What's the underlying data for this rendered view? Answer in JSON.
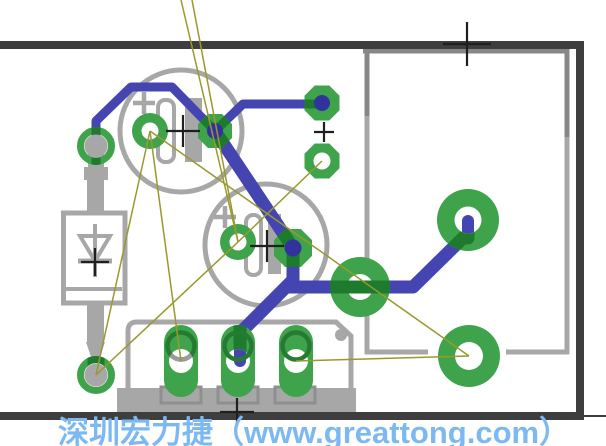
{
  "watermark": {
    "text": "深圳宏力捷（www.greattong.com）",
    "color": "#7cb9f3"
  },
  "colors": {
    "background": "#ffffff",
    "board_outline": "#3e3e3e",
    "silkscreen": "#a7a7a7",
    "silkscreen_dark": "#878787",
    "silkscreen_pin": "#8f8f8f",
    "pad_green": "#3ea34a",
    "pad_dark_green": "#1e7b2e",
    "terminal_ring_green": "#267b33",
    "terminal_ring_gray": "#9b9b9b",
    "trace_blue": "#4545b2",
    "hole_blue": "#32329e",
    "airwire_olive": "#99992e",
    "cross_black": "#1f1f1f",
    "white": "#ffffff"
  },
  "board_outline": {
    "segments": [
      {
        "name": "board-edge-top",
        "x1": 0,
        "y1": 45,
        "x2": 584,
        "y2": 45,
        "w": 8
      },
      {
        "name": "board-edge-right",
        "x1": 580,
        "y1": 45,
        "x2": 580,
        "y2": 416,
        "w": 8
      },
      {
        "name": "board-edge-bottom",
        "x1": 0,
        "y1": 416,
        "x2": 584,
        "y2": 416,
        "w": 8
      },
      {
        "name": "board-edge-stub",
        "x1": 584,
        "y1": 416,
        "x2": 606,
        "y2": 416,
        "w": 2
      }
    ]
  },
  "silkscreen": {
    "capacitors": [
      {
        "name": "capacitor-1",
        "circle": {
          "cx": 181,
          "cy": 131,
          "r": 61
        },
        "plus": {
          "x": 144,
          "y": 103
        },
        "bar_outline": {
          "x": 158,
          "y": 100,
          "w": 16,
          "h": 62
        },
        "bar_solid": {
          "x": 185,
          "y": 98,
          "w": 17,
          "h": 64
        }
      },
      {
        "name": "capacitor-2",
        "circle": {
          "cx": 266,
          "cy": 245,
          "r": 61
        },
        "plus": {
          "x": 225,
          "y": 217
        },
        "bar_outline": {
          "x": 246,
          "y": 215,
          "w": 15,
          "h": 60
        },
        "bar_solid": {
          "x": 268,
          "y": 214,
          "w": 13,
          "h": 60
        }
      }
    ],
    "diode": {
      "name": "diode",
      "body": {
        "x": 63.5,
        "y": 213,
        "w": 61.5,
        "h": 90
      },
      "cathode_line": {
        "x1": 66,
        "y1": 289,
        "x2": 122,
        "y2": 289
      },
      "symbol_vline": {
        "x1": 95,
        "y1": 224,
        "x2": 95,
        "y2": 277
      },
      "symbol_triangle": [
        [
          80,
          236
        ],
        [
          110,
          236
        ],
        [
          95,
          261
        ]
      ],
      "symbol_bar": {
        "x1": 78,
        "y1": 261,
        "x2": 112,
        "y2": 261
      },
      "leads": [
        {
          "x": 88,
          "y": 151,
          "w": 16,
          "h": 18
        },
        {
          "x": 84,
          "y": 167,
          "w": 24,
          "h": 13
        },
        {
          "x": 87,
          "y": 179,
          "w": 17,
          "h": 34
        },
        {
          "x": 87,
          "y": 303,
          "w": 17,
          "h": 41
        }
      ],
      "lead_taper": [
        [
          86,
          342
        ],
        [
          105,
          342
        ],
        [
          100,
          357
        ],
        [
          91,
          357
        ]
      ]
    },
    "terminal_block": {
      "name": "terminal-block",
      "outline_path": "M128,392 L128,331 Q128,322 137,322 L336,322 L351,336 L351,392",
      "body_bar": {
        "x": 117,
        "y": 388,
        "w": 239,
        "h": 24
      },
      "pin_boxes": [
        {
          "x": 161,
          "y": 387,
          "w": 40,
          "h": 16
        },
        {
          "x": 218,
          "y": 387,
          "w": 40,
          "h": 16
        },
        {
          "x": 275,
          "y": 387,
          "w": 40,
          "h": 16
        }
      ],
      "marker_dot": {
        "cx": 341,
        "cy": 335,
        "r": 6
      }
    },
    "module_outline": {
      "name": "module-outline",
      "segments": [
        {
          "x1": 363,
          "y1": 51,
          "x2": 569,
          "y2": 51,
          "shade": "dark"
        },
        {
          "x1": 367,
          "y1": 49,
          "x2": 367,
          "y2": 116,
          "shade": "dark"
        },
        {
          "x1": 367,
          "y1": 116,
          "x2": 367,
          "y2": 354,
          "shade": "light"
        },
        {
          "x1": 567,
          "y1": 49,
          "x2": 567,
          "y2": 137,
          "shade": "dark"
        },
        {
          "x1": 567,
          "y1": 137,
          "x2": 567,
          "y2": 354,
          "shade": "light"
        },
        {
          "x1": 365,
          "y1": 352,
          "x2": 428,
          "y2": 352,
          "shade": "light"
        },
        {
          "x1": 506,
          "y1": 352,
          "x2": 569,
          "y2": 352,
          "shade": "light"
        }
      ]
    }
  },
  "traces": [
    {
      "name": "trace-diode-to-cap1",
      "points": [
        [
          96,
          152
        ],
        [
          96,
          121
        ],
        [
          131,
          87
        ],
        [
          172,
          87
        ],
        [
          215,
          131
        ]
      ],
      "width": 9
    },
    {
      "name": "trace-cap1-to-header",
      "points": [
        [
          215,
          131
        ],
        [
          243,
          104
        ],
        [
          322,
          104
        ]
      ],
      "width": 9
    },
    {
      "name": "trace-cap1-to-cap2",
      "points": [
        [
          215,
          131
        ],
        [
          293,
          248
        ]
      ],
      "width": 13
    },
    {
      "name": "trace-cap2-to-terminal",
      "points": [
        [
          293,
          248
        ],
        [
          293,
          280
        ],
        [
          240,
          333
        ],
        [
          240,
          360
        ]
      ],
      "width": 13
    },
    {
      "name": "trace-cap2-to-power",
      "points": [
        [
          290,
          287
        ],
        [
          413,
          287
        ],
        [
          468,
          233
        ],
        [
          468,
          220
        ]
      ],
      "width": 13
    }
  ],
  "pads": [
    {
      "name": "diode-pad-top",
      "shape": "ring",
      "cx": 96,
      "cy": 146,
      "r": 15.5,
      "ring_w": 7,
      "lead_r": 11.5,
      "overlays": [
        {
          "pts": [
            [
              96,
              120
            ],
            [
              96,
              168
            ]
          ],
          "w": 9
        }
      ]
    },
    {
      "name": "diode-pad-bottom",
      "shape": "ring",
      "cx": 96,
      "cy": 375,
      "r": 15.5,
      "ring_w": 7,
      "lead_r": 11.5,
      "overlays": [
        {
          "pts": [
            [
              96,
              344
            ],
            [
              96,
              375
            ]
          ],
          "w": 17
        }
      ]
    },
    {
      "name": "cap1-pad-neg",
      "shape": "round",
      "cx": 150,
      "cy": 131,
      "r": 18,
      "hole": {
        "r": 8.5,
        "style": "white"
      }
    },
    {
      "name": "cap1-pad-pos",
      "shape": "octagon",
      "cx": 215,
      "cy": 131,
      "a": 17,
      "hole": {
        "r": 8,
        "style": "blue"
      },
      "overlays": [
        {
          "pts": [
            [
              172,
              87
            ],
            [
              215,
              131
            ]
          ],
          "w": 9
        },
        {
          "pts": [
            [
              215,
              131
            ],
            [
              243,
              104
            ]
          ],
          "w": 9
        },
        {
          "pts": [
            [
              215,
              131
            ],
            [
              293,
              248
            ]
          ],
          "w": 13
        }
      ]
    },
    {
      "name": "header-pad-top",
      "shape": "octagon",
      "cx": 322,
      "cy": 103,
      "a": 17.5,
      "hole": {
        "r": 8,
        "style": "blue"
      },
      "overlays": [
        {
          "pts": [
            [
              243,
              104
            ],
            [
              322,
              104
            ]
          ],
          "w": 9
        }
      ]
    },
    {
      "name": "header-pad-bottom",
      "shape": "octagon",
      "cx": 322,
      "cy": 161,
      "a": 17.5,
      "hole": {
        "r": 8.5,
        "style": "white"
      }
    },
    {
      "name": "cap2-pad-neg",
      "shape": "round",
      "cx": 238,
      "cy": 242,
      "r": 18,
      "hole": {
        "r": 8.5,
        "style": "white"
      }
    },
    {
      "name": "cap2-pad-pos",
      "shape": "octagon",
      "cx": 293,
      "cy": 248,
      "a": 19,
      "hole": {
        "r": 8.5,
        "style": "blue"
      },
      "overlays": [
        {
          "pts": [
            [
              215,
              131
            ],
            [
              293,
              248
            ]
          ],
          "w": 13
        },
        {
          "pts": [
            [
              293,
              248
            ],
            [
              293,
              282
            ]
          ],
          "w": 13
        }
      ]
    },
    {
      "name": "power-pad-1",
      "shape": "round",
      "cx": 468,
      "cy": 220,
      "r": 31,
      "hole": {
        "r": 13.5,
        "style": "white"
      },
      "overlays": [
        {
          "pts": [
            [
              413,
              287
            ],
            [
              468,
              233
            ]
          ],
          "w": 13
        },
        {
          "pts": [
            [
              468,
              238
            ],
            [
              468,
              220
            ]
          ],
          "w": 13
        }
      ],
      "stub": {
        "pts": [
          [
            468,
            236
          ],
          [
            468,
            221
          ]
        ],
        "w": 12
      }
    },
    {
      "name": "power-pad-2",
      "shape": "round",
      "cx": 360,
      "cy": 287,
      "r": 30,
      "hole": {
        "r": 13,
        "style": "white",
        "under": true
      },
      "overlays": [
        {
          "pts": [
            [
              292,
              287
            ],
            [
              428,
              287
            ]
          ],
          "w": 13
        }
      ]
    },
    {
      "name": "power-pad-3",
      "shape": "round",
      "cx": 469,
      "cy": 356,
      "r": 31,
      "hole": {
        "r": 14,
        "style": "white"
      }
    },
    {
      "name": "terminal-pad-1",
      "shape": "oval",
      "cx": 181,
      "cy": 361,
      "w": 34,
      "h": 72,
      "hole": {
        "r": 12,
        "style": "white"
      },
      "ring": {
        "cy": 346,
        "r": 13.5,
        "w": 4.5,
        "gray_arc": true
      }
    },
    {
      "name": "terminal-pad-2",
      "shape": "oval",
      "cx": 238,
      "cy": 361,
      "w": 34,
      "h": 72,
      "hole": {
        "r": 12,
        "style": "white"
      },
      "ring": {
        "cy": 346,
        "r": 13.5,
        "w": 4.5
      },
      "overlays": [
        {
          "pts": [
            [
              240,
              326
            ],
            [
              240,
              360
            ]
          ],
          "w": 13
        }
      ],
      "stub": {
        "pts": [
          [
            240,
            350
          ],
          [
            240,
            361
          ]
        ],
        "w": 12
      }
    },
    {
      "name": "terminal-pad-3",
      "shape": "oval",
      "cx": 296,
      "cy": 361,
      "w": 34,
      "h": 72,
      "hole": {
        "r": 12,
        "style": "white"
      },
      "ring": {
        "cy": 346,
        "r": 13.5,
        "w": 4.5
      }
    }
  ],
  "airwires": [
    {
      "name": "airwire",
      "x1": 181,
      "y1": 0,
      "x2": 238,
      "y2": 242
    },
    {
      "name": "airwire",
      "x1": 192,
      "y1": 0,
      "x2": 238,
      "y2": 242
    },
    {
      "name": "airwire",
      "x1": 150,
      "y1": 131,
      "x2": 96,
      "y2": 375
    },
    {
      "name": "airwire",
      "x1": 150,
      "y1": 131,
      "x2": 181,
      "y2": 361
    },
    {
      "name": "airwire",
      "x1": 238,
      "y1": 242,
      "x2": 96,
      "y2": 375
    },
    {
      "name": "airwire",
      "x1": 238,
      "y1": 242,
      "x2": 322,
      "y2": 161
    },
    {
      "name": "airwire",
      "x1": 150,
      "y1": 131,
      "x2": 469,
      "y2": 356
    },
    {
      "name": "airwire",
      "x1": 296,
      "y1": 361,
      "x2": 469,
      "y2": 356
    }
  ],
  "origin_crosses": [
    {
      "name": "origin-cross-diode",
      "x": 95,
      "y": 262,
      "ax": 14,
      "ay": 14
    },
    {
      "name": "origin-cross-cap1",
      "x": 183,
      "y": 131,
      "ax": 17,
      "ay": 16
    },
    {
      "name": "origin-cross-cap2",
      "x": 267,
      "y": 246,
      "ax": 17,
      "ay": 16
    },
    {
      "name": "origin-cross-header",
      "x": 324,
      "y": 132,
      "ax": 10,
      "ay": 10
    },
    {
      "name": "origin-cross-module",
      "x": 467,
      "y": 44,
      "ax": 24,
      "ay": 22
    },
    {
      "name": "origin-cross-terminal",
      "x": 237,
      "y": 412,
      "ax": 17,
      "ay": 14
    }
  ]
}
